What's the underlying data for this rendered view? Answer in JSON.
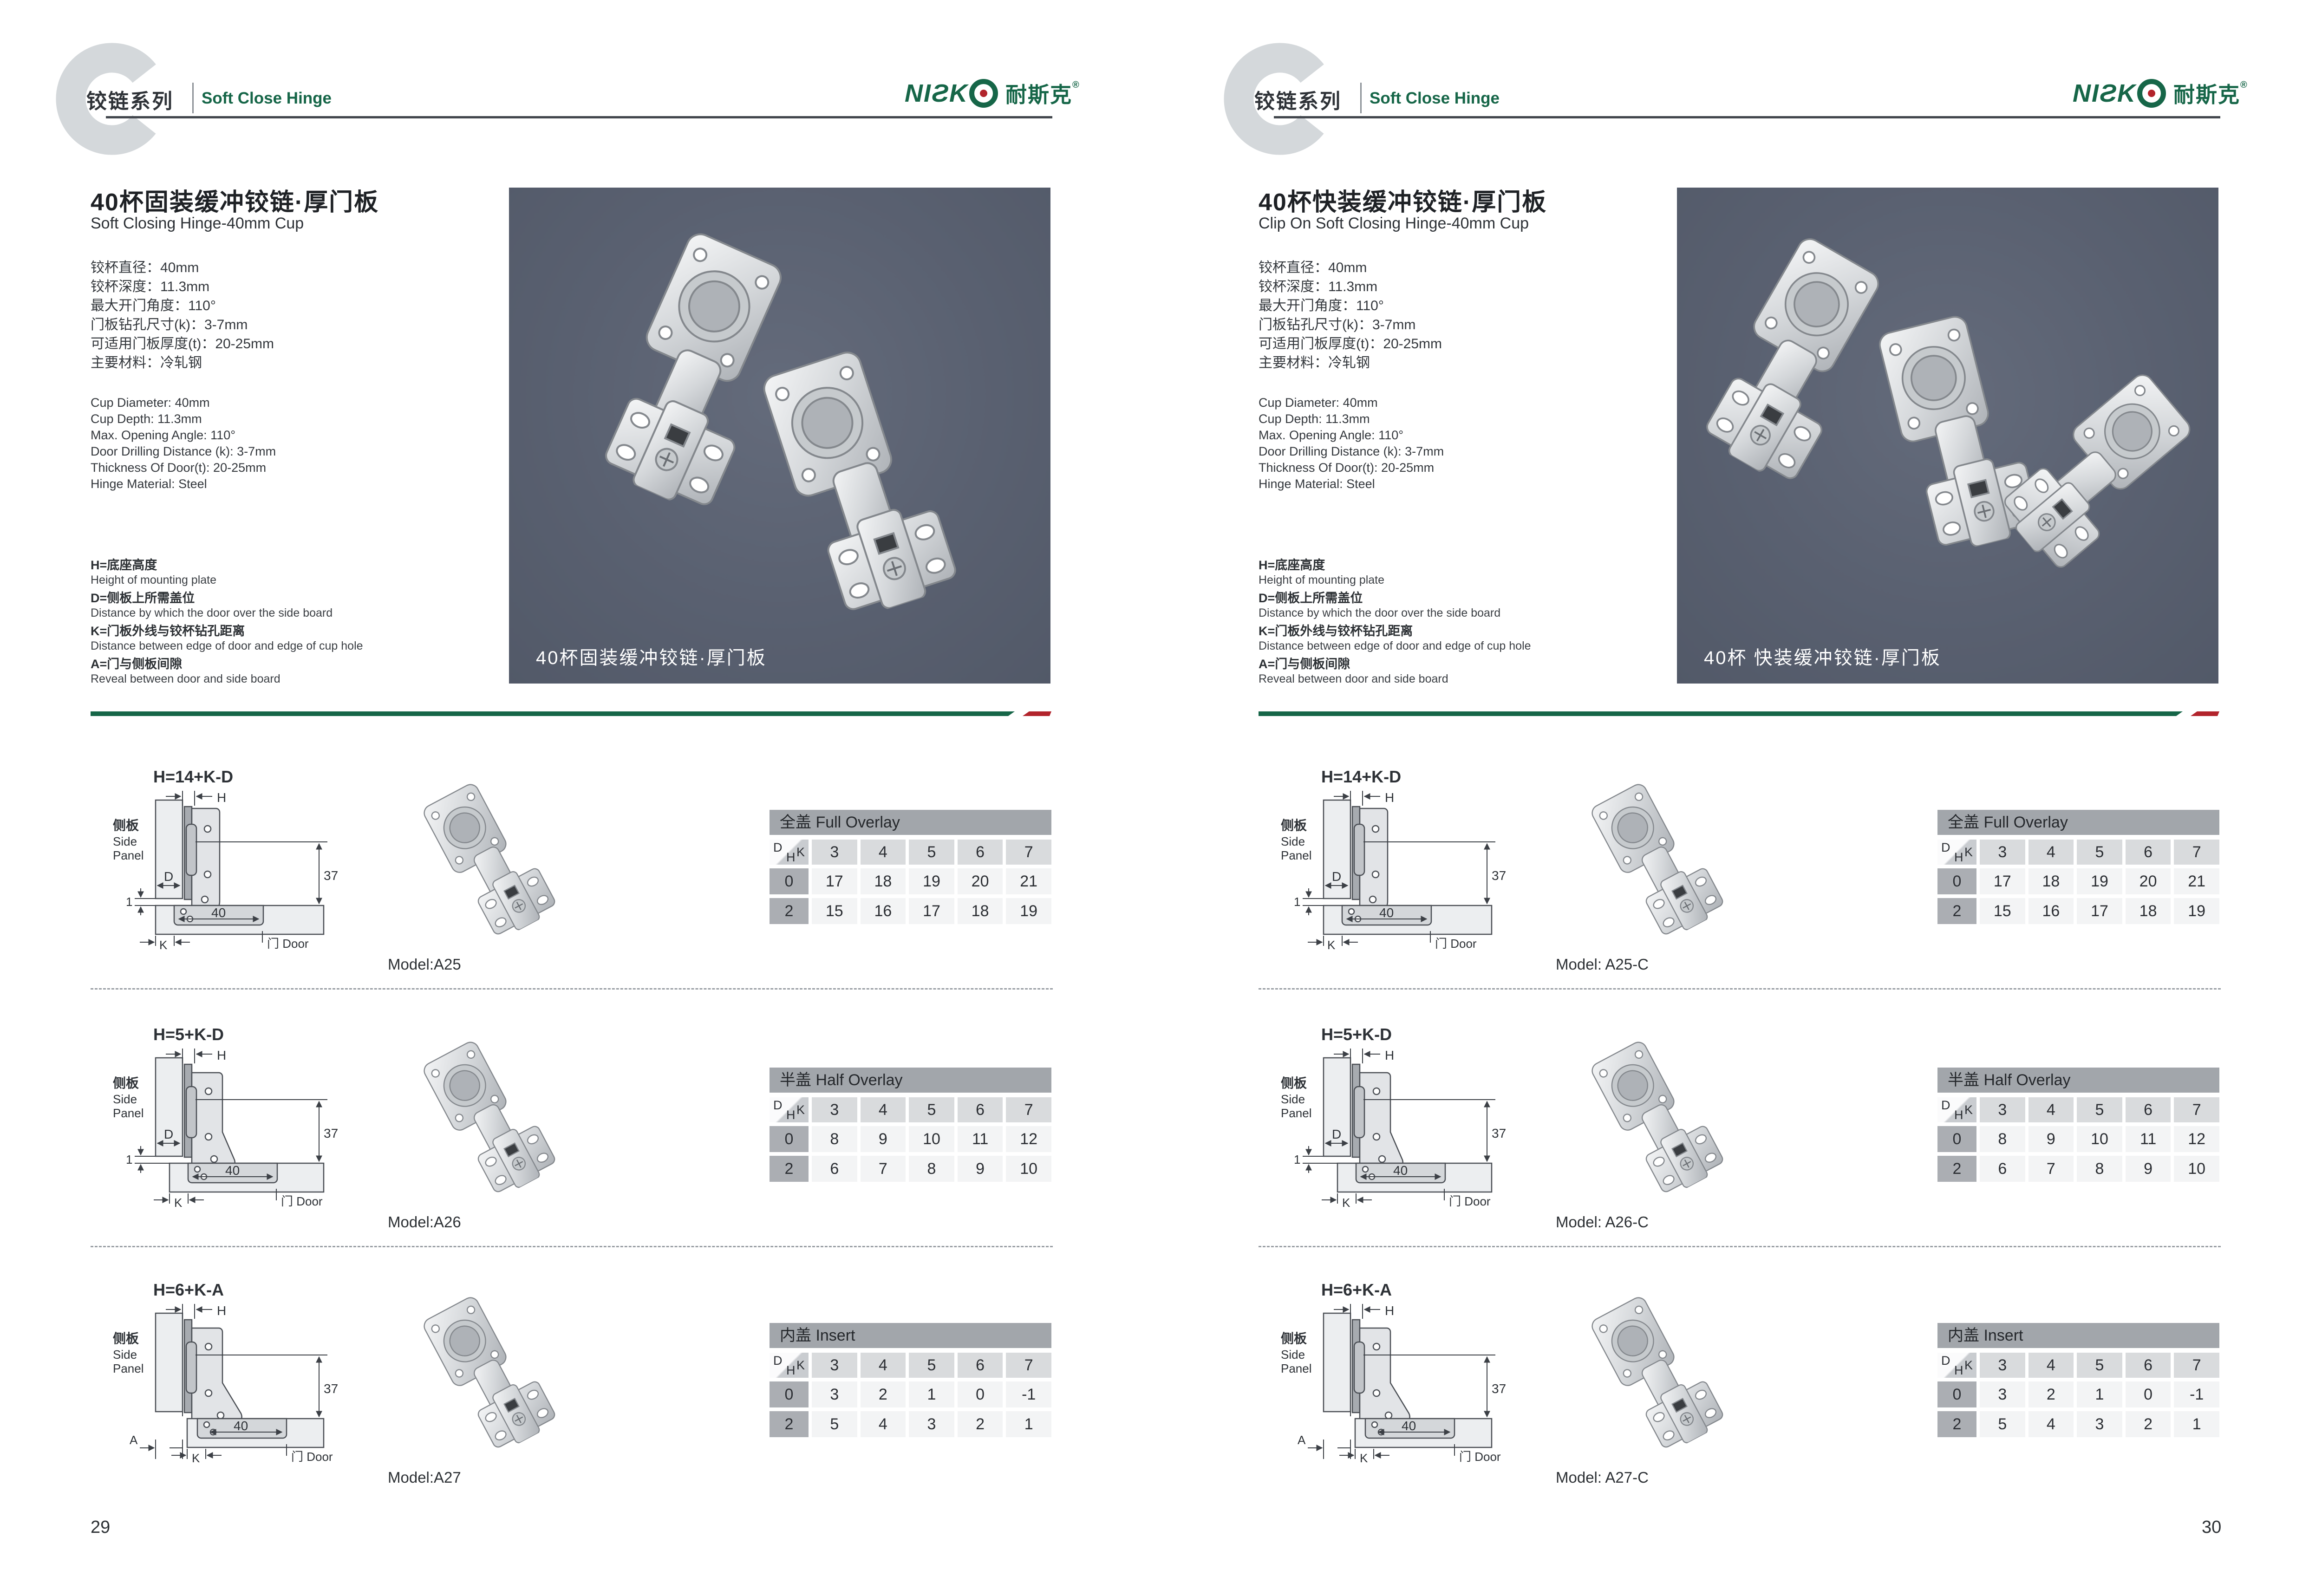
{
  "header": {
    "series_cn": "铰链系列",
    "series_en": "Soft Close Hinge",
    "logo_en": "NIƧK",
    "logo_cn": "耐斯克",
    "logo_reg": "®"
  },
  "colors": {
    "accent_green": "#166648",
    "accent_red": "#b2242c",
    "photo_background": "#596070",
    "table_title_bar": "#a2a6ab"
  },
  "table_corner": {
    "d": "D",
    "h": "H",
    "k": "K"
  },
  "diagram_labels": {
    "side_panel_cn": "侧板",
    "side_panel_en_1": "Side",
    "side_panel_en_2": "Panel",
    "door": "门 Door",
    "h": "H",
    "d": "D",
    "k": "K",
    "dim_37": "37",
    "dim_1": "1",
    "dim_40": "40"
  },
  "pages": [
    {
      "page_number": "29",
      "title_cn": "40杯固装缓冲铰链·厚门板",
      "title_en": "Soft Closing Hinge-40mm Cup",
      "specs_cn": [
        "铰杯直径：40mm",
        "铰杯深度：11.3mm",
        "最大开门角度：110°",
        "门板钻孔尺寸(k)：3-7mm",
        "可适用门板厚度(t)：20-25mm",
        "主要材料：冷轧钢"
      ],
      "specs_en": [
        "Cup Diameter: 40mm",
        "Cup Depth: 11.3mm",
        "Max. Opening Angle: 110°",
        "Door Drilling Distance (k): 3-7mm",
        "Thickness Of Door(t): 20-25mm",
        "Hinge Material: Steel"
      ],
      "legend": [
        {
          "cn": "H=底座高度",
          "en": "Height of mounting plate"
        },
        {
          "cn": "D=侧板上所需盖位",
          "en": "Distance by which the door over the side board"
        },
        {
          "cn": "K=门板外线与铰杯钻孔距离",
          "en": "Distance between edge of door and edge of cup hole"
        },
        {
          "cn": "A=门与侧板间隙",
          "en": "Reveal between door and side board"
        }
      ],
      "photo_caption": "40杯固装缓冲铰链·厚门板",
      "rows": [
        {
          "formula": "H=14+K-D",
          "a_label": "",
          "model": "Model:A25",
          "table": {
            "title": "全盖 Full Overlay",
            "k": [
              "3",
              "4",
              "5",
              "6",
              "7"
            ],
            "r0_label": "0",
            "r0": [
              "17",
              "18",
              "19",
              "20",
              "21"
            ],
            "r2_label": "2",
            "r2": [
              "15",
              "16",
              "17",
              "18",
              "19"
            ]
          }
        },
        {
          "formula": "H=5+K-D",
          "a_label": "",
          "model": "Model:A26",
          "table": {
            "title": "半盖 Half Overlay",
            "k": [
              "3",
              "4",
              "5",
              "6",
              "7"
            ],
            "r0_label": "0",
            "r0": [
              "8",
              "9",
              "10",
              "11",
              "12"
            ],
            "r2_label": "2",
            "r2": [
              "6",
              "7",
              "8",
              "9",
              "10"
            ]
          }
        },
        {
          "formula": "H=6+K-A",
          "a_label": "A",
          "model": "Model:A27",
          "table": {
            "title": "内盖 Insert",
            "k": [
              "3",
              "4",
              "5",
              "6",
              "7"
            ],
            "r0_label": "0",
            "r0": [
              "3",
              "2",
              "1",
              "0",
              "-1"
            ],
            "r2_label": "2",
            "r2": [
              "5",
              "4",
              "3",
              "2",
              "1"
            ]
          }
        }
      ]
    },
    {
      "page_number": "30",
      "title_cn": "40杯快装缓冲铰链·厚门板",
      "title_en": "Clip On Soft Closing Hinge-40mm Cup",
      "specs_cn": [
        "铰杯直径：40mm",
        "铰杯深度：11.3mm",
        "最大开门角度：110°",
        "门板钻孔尺寸(k)：3-7mm",
        "可适用门板厚度(t)：20-25mm",
        "主要材料：冷轧钢"
      ],
      "specs_en": [
        "Cup Diameter: 40mm",
        "Cup Depth: 11.3mm",
        "Max. Opening Angle: 110°",
        "Door Drilling Distance (k): 3-7mm",
        "Thickness Of Door(t): 20-25mm",
        "Hinge Material: Steel"
      ],
      "legend": [
        {
          "cn": "H=底座高度",
          "en": "Height of mounting plate"
        },
        {
          "cn": "D=侧板上所需盖位",
          "en": "Distance by which the door over the side board"
        },
        {
          "cn": "K=门板外线与铰杯钻孔距离",
          "en": "Distance between edge of door and edge of cup hole"
        },
        {
          "cn": "A=门与侧板间隙",
          "en": "Reveal between door and side board"
        }
      ],
      "photo_caption": "40杯 快装缓冲铰链·厚门板",
      "rows": [
        {
          "formula": "H=14+K-D",
          "a_label": "",
          "model": "Model: A25-C",
          "table": {
            "title": "全盖 Full Overlay",
            "k": [
              "3",
              "4",
              "5",
              "6",
              "7"
            ],
            "r0_label": "0",
            "r0": [
              "17",
              "18",
              "19",
              "20",
              "21"
            ],
            "r2_label": "2",
            "r2": [
              "15",
              "16",
              "17",
              "18",
              "19"
            ]
          }
        },
        {
          "formula": "H=5+K-D",
          "a_label": "",
          "model": "Model: A26-C",
          "table": {
            "title": "半盖 Half Overlay",
            "k": [
              "3",
              "4",
              "5",
              "6",
              "7"
            ],
            "r0_label": "0",
            "r0": [
              "8",
              "9",
              "10",
              "11",
              "12"
            ],
            "r2_label": "2",
            "r2": [
              "6",
              "7",
              "8",
              "9",
              "10"
            ]
          }
        },
        {
          "formula": "H=6+K-A",
          "a_label": "A",
          "model": "Model: A27-C",
          "table": {
            "title": "内盖 Insert",
            "k": [
              "3",
              "4",
              "5",
              "6",
              "7"
            ],
            "r0_label": "0",
            "r0": [
              "3",
              "2",
              "1",
              "0",
              "-1"
            ],
            "r2_label": "2",
            "r2": [
              "5",
              "4",
              "3",
              "2",
              "1"
            ]
          }
        }
      ]
    }
  ]
}
